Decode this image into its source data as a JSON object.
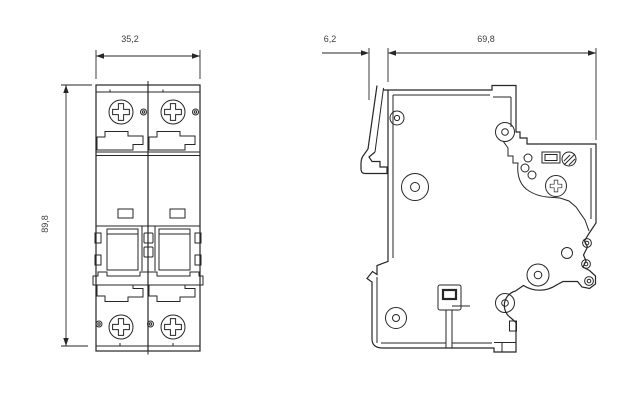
{
  "drawing": {
    "background_color": "#ffffff",
    "line_color": "#262626",
    "dim_text_color": "#3d3d3d",
    "front_view": {
      "width_dim_label": "35,2",
      "height_dim_label": "89,8"
    },
    "side_view": {
      "rail_offset_dim_label": "6,2",
      "depth_dim_label": "69,8"
    }
  }
}
